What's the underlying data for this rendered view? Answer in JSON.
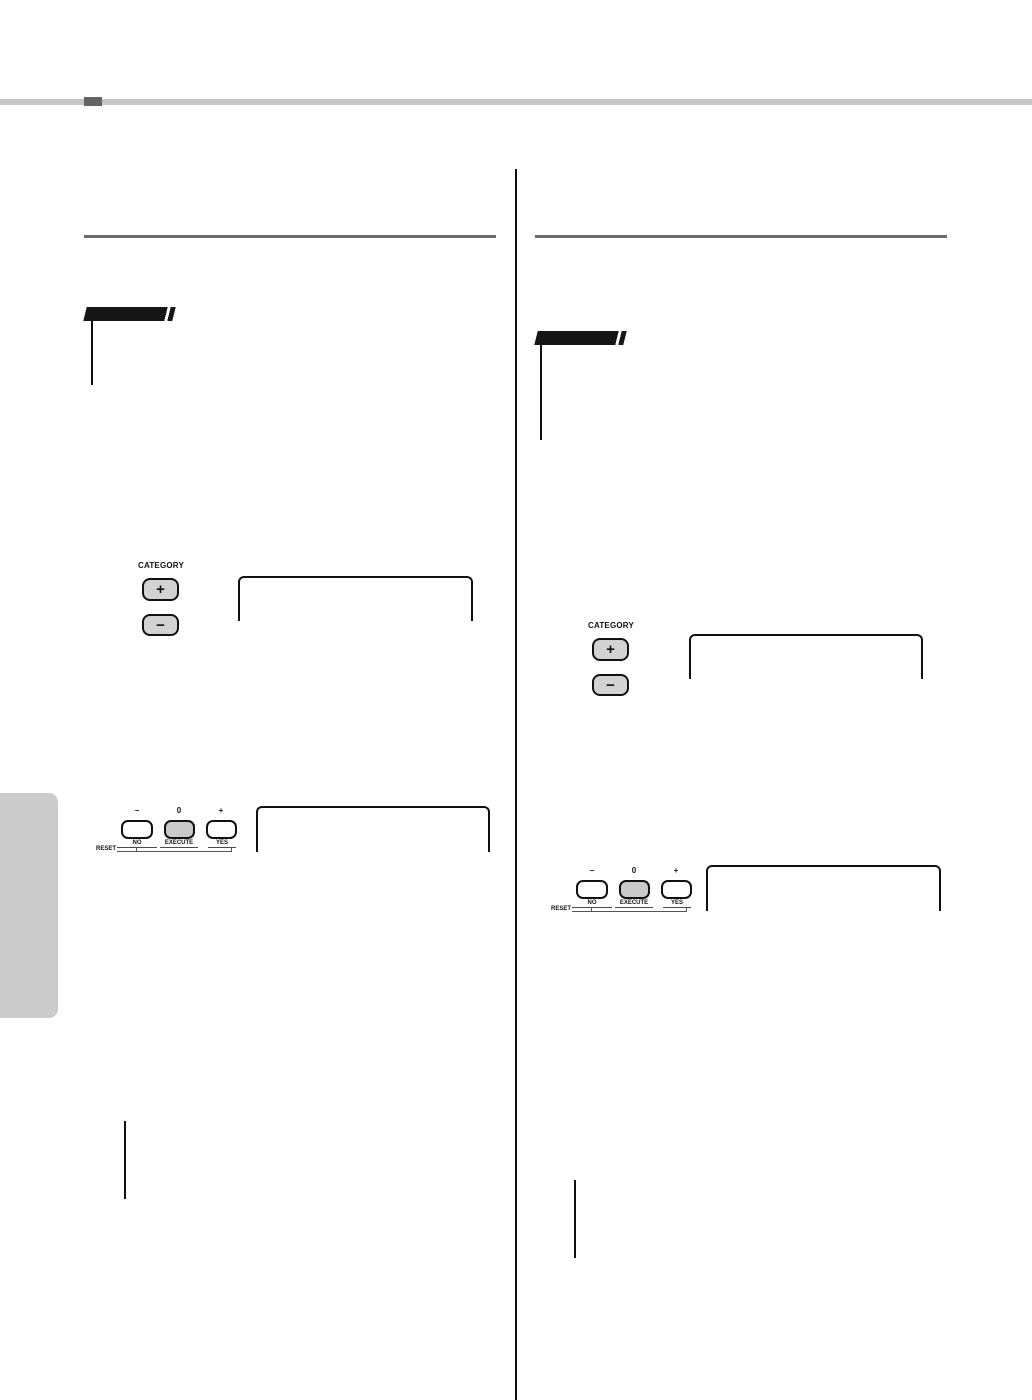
{
  "header": {
    "bar_color": "#c6c6c6",
    "accent_color": "#646464"
  },
  "controls": {
    "category": {
      "label": "CATEGORY",
      "plus": "+",
      "minus": "−"
    },
    "value_buttons": {
      "above": [
        "−",
        "0",
        "+"
      ],
      "below": [
        "NO",
        "EXECUTE",
        "YES"
      ],
      "reset": "RESET"
    }
  },
  "colors": {
    "rule_gray": "#6b6b6b",
    "banner_black": "#161616",
    "button_gray": "#d2d2d2",
    "execute_gray": "#c9c9c9",
    "tab_gray": "#cbcbcb",
    "divider_black": "#111111"
  }
}
